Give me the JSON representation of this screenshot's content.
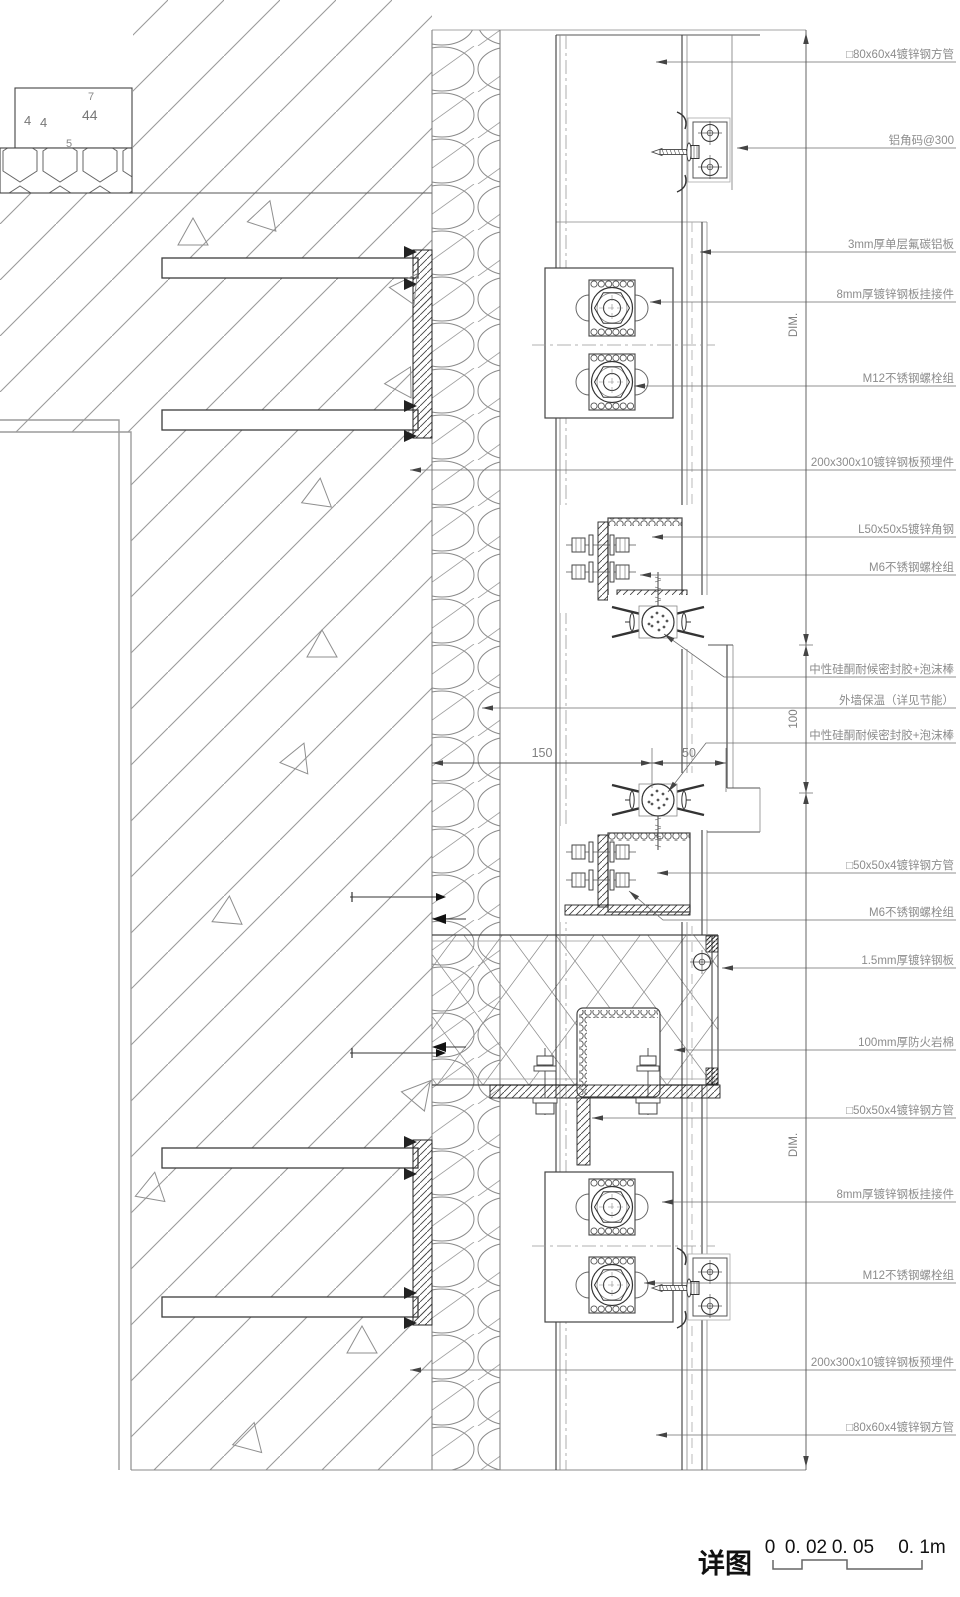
{
  "title": {
    "label": "详图"
  },
  "scale_bar": {
    "labels": [
      "0",
      "0. 02",
      "0. 05",
      "0. 1m"
    ]
  },
  "wall": {
    "plaster_marks": [
      "4",
      "4",
      "44",
      "7",
      "5"
    ]
  },
  "callouts": [
    {
      "text": "□80x60x4镀锌钢方管",
      "y": 62,
      "tip": [
        656,
        62
      ]
    },
    {
      "text": "铝角码@300",
      "y": 148,
      "tip": [
        737,
        148
      ]
    },
    {
      "text": "3mm厚单层氟碳铝板",
      "y": 252,
      "tip": [
        700,
        252
      ]
    },
    {
      "text": "8mm厚镀锌钢板挂接件",
      "y": 302,
      "tip": [
        650,
        302
      ]
    },
    {
      "text": "M12不锈钢螺栓组",
      "y": 386,
      "tip": [
        634,
        386
      ]
    },
    {
      "text": "200x300x10镀锌钢板预埋件",
      "y": 470,
      "tip": [
        410,
        470
      ]
    },
    {
      "text": "L50x50x5镀锌角钢",
      "y": 537,
      "tip": [
        652,
        537
      ]
    },
    {
      "text": "M6不锈钢螺栓组",
      "y": 575,
      "tip": [
        640,
        575
      ]
    },
    {
      "text": "中性硅酮耐候密封胶+泡沫棒",
      "y": 677,
      "tip": [
        664,
        634
      ],
      "bend": [
        724,
        677
      ]
    },
    {
      "text": "外墙保温（详见节能）",
      "y": 708,
      "tip": [
        482,
        708
      ]
    },
    {
      "text": "中性硅酮耐候密封胶+泡沫棒",
      "y": 743,
      "tip": [
        668,
        792
      ],
      "bend": [
        706,
        743
      ]
    },
    {
      "text": "□50x50x4镀锌钢方管",
      "y": 873,
      "tip": [
        657,
        873
      ]
    },
    {
      "text": "M6不锈钢螺栓组",
      "y": 920,
      "tip": [
        629,
        891
      ],
      "bend": [
        663,
        920
      ]
    },
    {
      "text": "1.5mm厚镀锌钢板",
      "y": 968,
      "tip": [
        722,
        968
      ]
    },
    {
      "text": "100mm厚防火岩棉",
      "y": 1050,
      "tip": [
        674,
        1050
      ]
    },
    {
      "text": "□50x50x4镀锌钢方管",
      "y": 1118,
      "tip": [
        592,
        1118
      ]
    },
    {
      "text": "8mm厚镀锌钢板挂接件",
      "y": 1202,
      "tip": [
        662,
        1202
      ]
    },
    {
      "text": "M12不锈钢螺栓组",
      "y": 1283,
      "tip": [
        644,
        1283
      ]
    },
    {
      "text": "200x300x10镀锌钢板预埋件",
      "y": 1370,
      "tip": [
        410,
        1370
      ]
    },
    {
      "text": "□80x60x4镀锌钢方管",
      "y": 1435,
      "tip": [
        656,
        1435
      ]
    }
  ],
  "dim_horizontal": {
    "y": 763,
    "segments": [
      {
        "label": "150",
        "x1": 432,
        "x2": 652
      },
      {
        "label": "50",
        "x1": 652,
        "x2": 726
      }
    ]
  },
  "dim_vertical": {
    "x": 806,
    "segments": [
      {
        "label": "DIM.",
        "y1": 33,
        "y2": 645,
        "label_y": 325
      },
      {
        "label": "100",
        "y1": 645,
        "y2": 793
      },
      {
        "label": "DIM.",
        "y1": 793,
        "y2": 1467,
        "label_y": 1145
      }
    ]
  },
  "colors": {
    "line": "#3c3c3c",
    "hatch": "#9a9a9a",
    "label_text": "#8c8c8c",
    "dim_text": "#808080"
  }
}
